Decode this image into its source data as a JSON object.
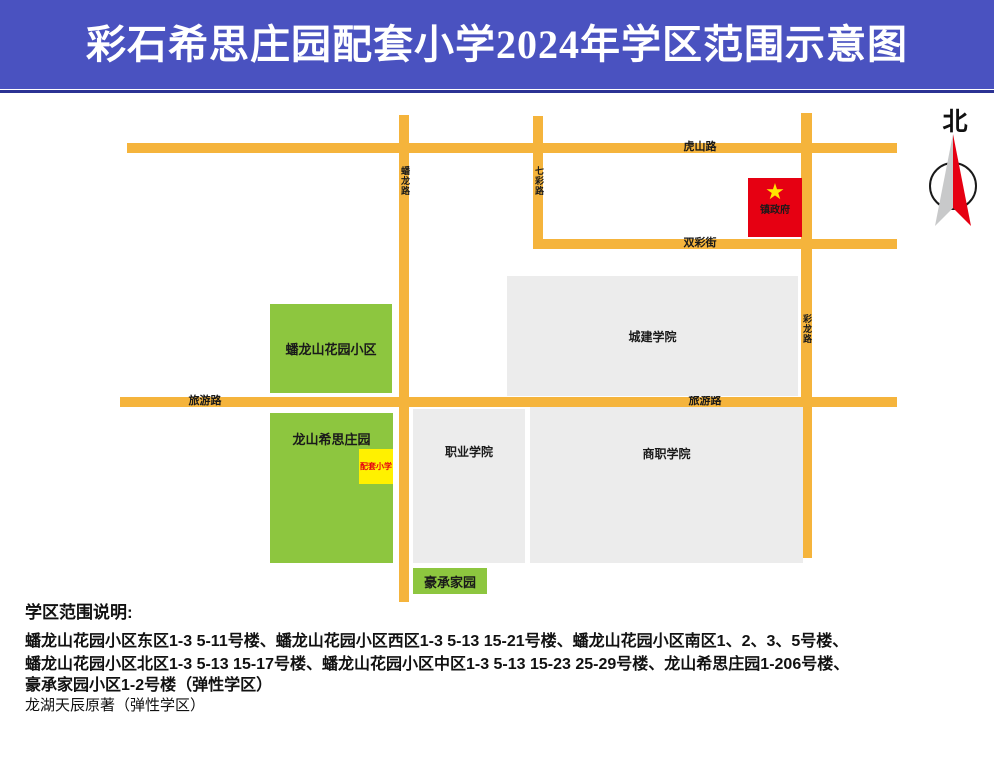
{
  "title": "彩石希思庄园配套小学2024年学区范围示意图",
  "compass": {
    "north_label": "北"
  },
  "map": {
    "roads": [
      {
        "name": "虎山路",
        "orientation": "horizontal"
      },
      {
        "name": "双彩街",
        "orientation": "horizontal"
      },
      {
        "name": "旅游路",
        "orientation": "horizontal"
      },
      {
        "name": "蟠龙路",
        "orientation": "vertical"
      },
      {
        "name": "七彩路",
        "orientation": "vertical"
      },
      {
        "name": "彩龙路",
        "orientation": "vertical"
      }
    ],
    "blocks": [
      {
        "label": "蟠龙山花园小区",
        "type": "residential"
      },
      {
        "label": "龙山希思庄园",
        "type": "residential"
      },
      {
        "label": "配套小学",
        "type": "school"
      },
      {
        "label": "豪承家园",
        "type": "residential"
      },
      {
        "label": "城建学院",
        "type": "institution"
      },
      {
        "label": "职业学院",
        "type": "institution"
      },
      {
        "label": "商职学院",
        "type": "institution"
      },
      {
        "label": "镇政府",
        "type": "government"
      }
    ],
    "icons": {
      "star": "★"
    }
  },
  "legend": {
    "heading": "学区范围说明:",
    "lines": [
      "蟠龙山花园小区东区1-3 5-11号楼、蟠龙山花园小区西区1-3 5-13 15-21号楼、蟠龙山花园小区南区1、2、3、5号楼、",
      "蟠龙山花园小区北区1-3 5-13 15-17号楼、蟠龙山花园小区中区1-3 5-13 15-23 25-29号楼、龙山希思庄园1-206号楼、",
      "豪承家园小区1-2号楼（弹性学区）",
      "龙湖天辰原著（弹性学区）"
    ]
  },
  "colors": {
    "header_blue": "#4A52C0",
    "header_underline": "#2B3294",
    "road_orange": "#F5B43C",
    "block_green": "#8DC63F",
    "block_gray": "#ECECEC",
    "government_red": "#E60012",
    "school_yellow": "#FFF100",
    "star_yellow": "#FFE600",
    "compass_red": "#E60012",
    "compass_gray": "#C8C9CA"
  }
}
